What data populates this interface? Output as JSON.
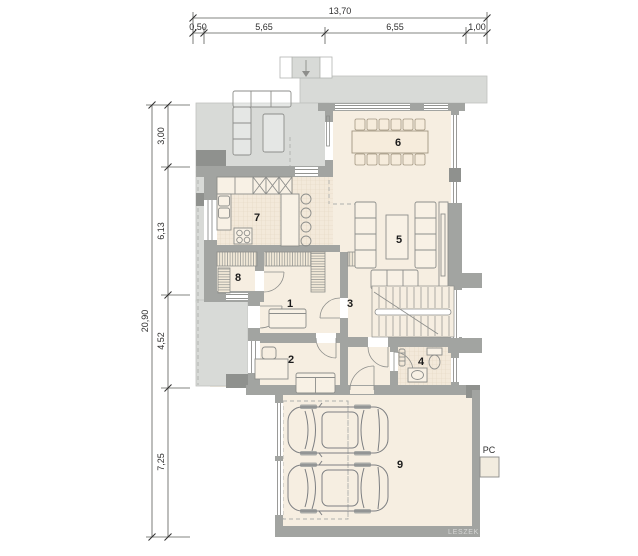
{
  "plan": {
    "watermark": "LESZEK KAL",
    "pc_label": "PC"
  },
  "dimensions": {
    "top_total": "13,70",
    "top_segments": [
      "0,50",
      "5,65",
      "6,55",
      "1,00"
    ],
    "left_total": "20,90",
    "left_segments": [
      "3,00",
      "6,13",
      "4,52",
      "7,25"
    ]
  },
  "rooms": [
    {
      "number": "1"
    },
    {
      "number": "2"
    },
    {
      "number": "3"
    },
    {
      "number": "4"
    },
    {
      "number": "5"
    },
    {
      "number": "6"
    },
    {
      "number": "7"
    },
    {
      "number": "8"
    },
    {
      "number": "9"
    }
  ],
  "colors": {
    "terrace_gray": "#d8dad7",
    "wall_gray": "#a2a4a1",
    "wall_dark": "#8f918e",
    "floor_beige": "#f6eee1",
    "outline_gray": "#8d8e8b",
    "dim_text": "#2e2e2e"
  }
}
